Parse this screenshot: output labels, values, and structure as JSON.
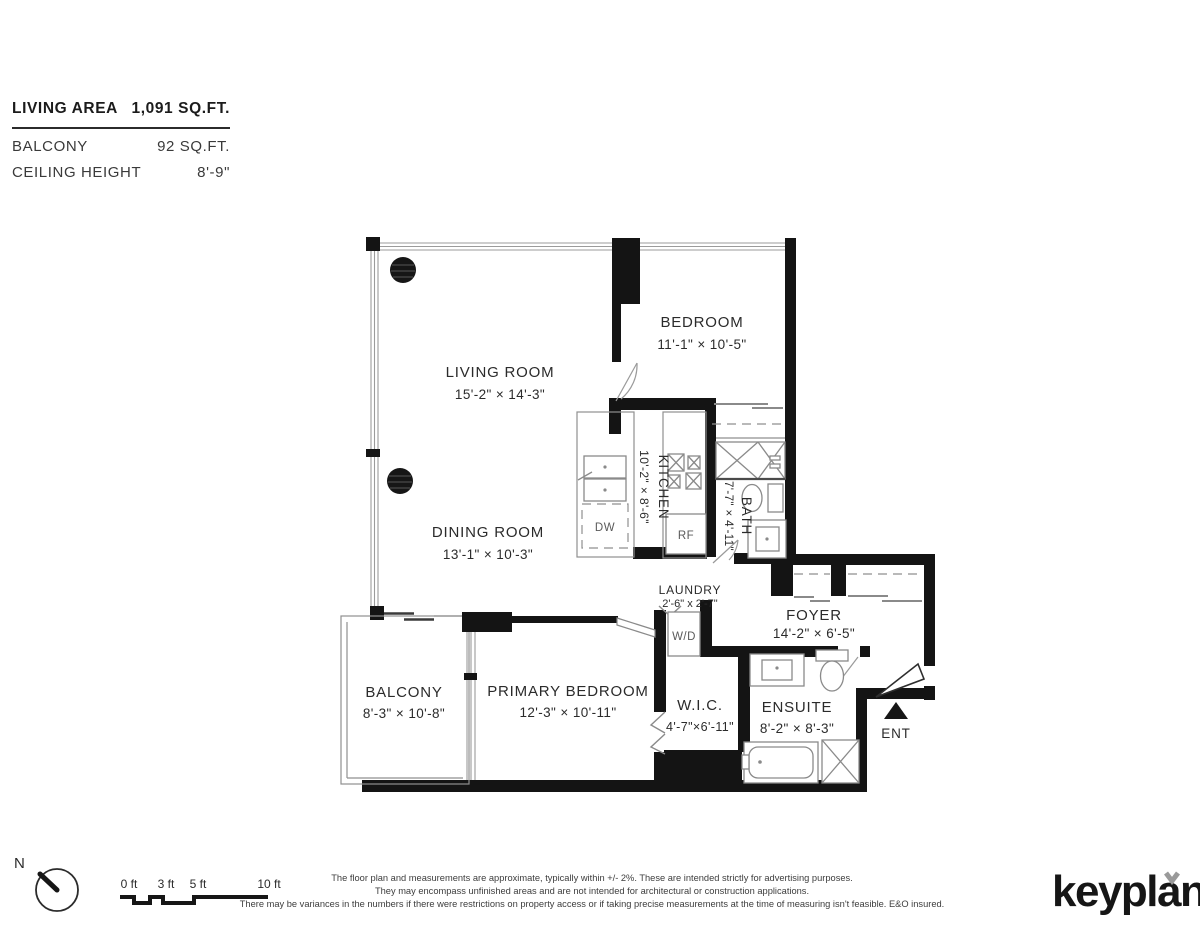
{
  "colors": {
    "wall": "#141414",
    "fixture": "#8a8a8a",
    "text": "#2b2b2b",
    "logo_mark": "#9a9a9a"
  },
  "summary": {
    "living_area_label": "LIVING AREA",
    "living_area_value": "1,091 SQ.FT.",
    "balcony_label": "BALCONY",
    "balcony_value": "92 SQ.FT.",
    "ceiling_label": "CEILING HEIGHT",
    "ceiling_value": "8'-9\""
  },
  "rooms": {
    "living": {
      "name": "LIVING ROOM",
      "dims": "15'-2\" × 14'-3\""
    },
    "bedroom": {
      "name": "BEDROOM",
      "dims": "11'-1\" × 10'-5\""
    },
    "dining": {
      "name": "DINING ROOM",
      "dims": "13'-1\" × 10'-3\""
    },
    "kitchen": {
      "name": "KITCHEN",
      "dims": "10'-2\" × 8'-6\""
    },
    "bath": {
      "name": "BATH",
      "dims": "7'-7\" × 4'-11\""
    },
    "laundry": {
      "name": "LAUNDRY",
      "dims": "2'-6\" x 2'-7\""
    },
    "foyer": {
      "name": "FOYER",
      "dims": "14'-2\" × 6'-5\""
    },
    "balcony": {
      "name": "BALCONY",
      "dims": "8'-3\" × 10'-8\""
    },
    "primary": {
      "name": "PRIMARY BEDROOM",
      "dims": "12'-3\" × 10'-11\""
    },
    "wic": {
      "name": "W.I.C.",
      "dims": "4'-7\"×6'-11\""
    },
    "ensuite": {
      "name": "ENSUITE",
      "dims": "8'-2\" × 8'-3\""
    }
  },
  "appliances": {
    "washer_dryer": "W/D",
    "dishwasher": "DW",
    "fridge": "RF"
  },
  "entry_label": "ENT",
  "compass": {
    "north_label": "N"
  },
  "scale_bar": {
    "tick0": "0 ft",
    "tick3": "3 ft",
    "tick5": "5 ft",
    "tick10": "10 ft"
  },
  "disclaimer": {
    "line1": "The floor plan and measurements are approximate, typically within +/- 2%. These are intended strictly for advertising purposes.",
    "line2": "They may encompass unfinished areas and are not intended for architectural or construction applications.",
    "line3": "There may be variances in the numbers if there were restrictions on property access or if taking precise measurements at the time of measuring isn't feasible. E&O insured."
  },
  "brand": {
    "logo": "keyplan"
  }
}
